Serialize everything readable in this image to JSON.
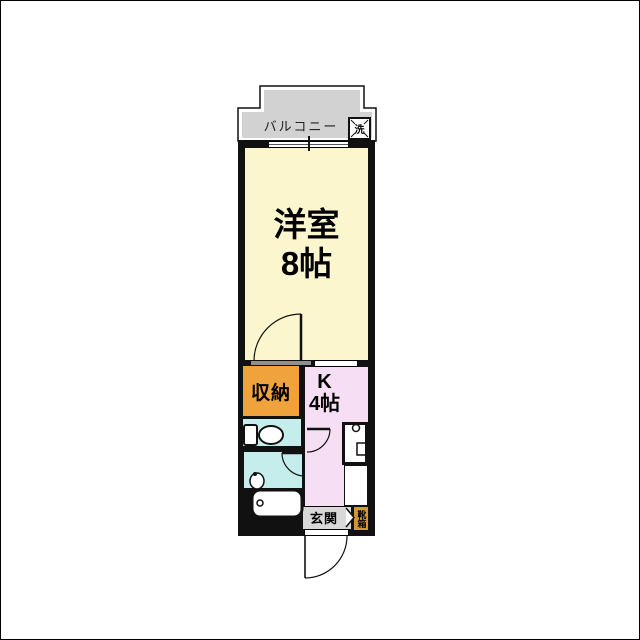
{
  "plan": {
    "type": "japanese-apartment-floor-plan",
    "rooms": {
      "balcony": {
        "label": "バルコニー"
      },
      "washer": {
        "label": "洗",
        "meaning": "washing machine place"
      },
      "main_room": {
        "label_line1": "洋室",
        "label_line2": "8帖"
      },
      "closet": {
        "label": "収納"
      },
      "kitchen": {
        "label_line1": "K",
        "label_line2": "4帖"
      },
      "entrance": {
        "label": "玄関"
      },
      "shoebox": {
        "label": "靴箱"
      }
    },
    "fixtures": [
      "toilet",
      "washbasin",
      "bathtub",
      "kitchen-sink",
      "refrigerator-space",
      "washing-machine-space"
    ],
    "colors": {
      "walls": "#111111",
      "balcony": "#D2D2D2",
      "main_room": "#FBF6CD",
      "kitchen": "#F6DFF4",
      "wet_rooms": "#C5EDEC",
      "closet": "#F0A23C",
      "shoebox": "#D9962F",
      "entrance": "#D8D8D8",
      "background": "#FFFFFF"
    }
  }
}
